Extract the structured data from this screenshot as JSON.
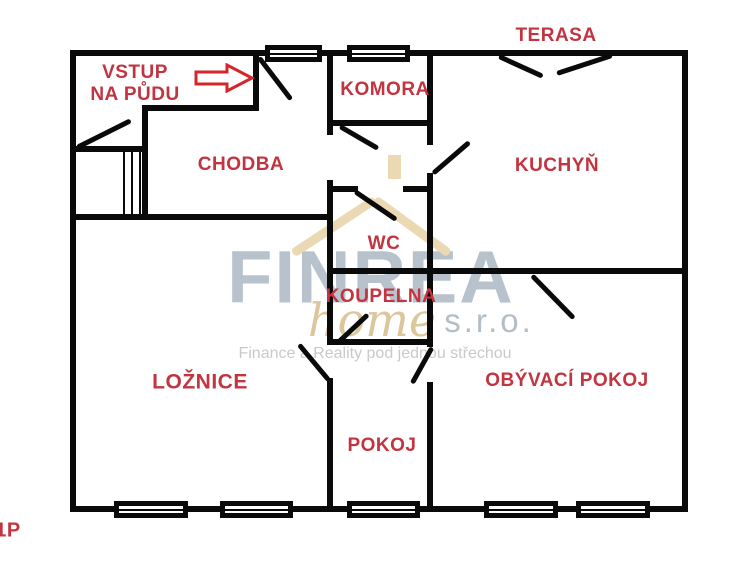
{
  "page": {
    "type": "floor-plan-image",
    "floor_tag": "1P"
  },
  "colors": {
    "wall": "#0a0a0a",
    "room_label": "#c23440",
    "arrow_outline": "#d4252b",
    "watermark_brand": "#b7c2cc",
    "watermark_home": "#dcc69c",
    "watermark_suffix": "#b3bec8",
    "watermark_tagline": "#c9c9c9",
    "watermark_roof": "#ead9b3",
    "background": "#ffffff"
  },
  "watermark": {
    "brand": "FINREA",
    "home": "home",
    "suffix": "s.r.o.",
    "tagline": "Finance a Reality pod jednou střechou"
  },
  "labels": [
    {
      "id": "vstup-na-pudu",
      "lines": [
        "VSTUP",
        "NA PŮDU"
      ],
      "x": 135,
      "y": 84,
      "fs": 19
    },
    {
      "id": "chodba",
      "lines": [
        "CHODBA"
      ],
      "x": 241,
      "y": 165,
      "fs": 19
    },
    {
      "id": "komora",
      "lines": [
        "KOMORA"
      ],
      "x": 385,
      "y": 90,
      "fs": 19
    },
    {
      "id": "terasa",
      "lines": [
        "TERASA"
      ],
      "x": 556,
      "y": 36,
      "fs": 19
    },
    {
      "id": "kuchyn",
      "lines": [
        "KUCHYŇ"
      ],
      "x": 557,
      "y": 166,
      "fs": 19
    },
    {
      "id": "wc",
      "lines": [
        "WC"
      ],
      "x": 384,
      "y": 244,
      "fs": 19
    },
    {
      "id": "koupelna",
      "lines": [
        "KOUPELNA"
      ],
      "x": 381,
      "y": 297,
      "fs": 19
    },
    {
      "id": "loznice",
      "lines": [
        "LOŽNICE"
      ],
      "x": 200,
      "y": 383,
      "fs": 21
    },
    {
      "id": "pokoj",
      "lines": [
        "POKOJ"
      ],
      "x": 382,
      "y": 446,
      "fs": 19
    },
    {
      "id": "obyvaci-pokoj",
      "lines": [
        "OBÝVACÍ POKOJ"
      ],
      "x": 567,
      "y": 381,
      "fs": 19
    },
    {
      "id": "floor-tag",
      "lines": [
        "1P"
      ],
      "x": 8,
      "y": 531,
      "fs": 20
    }
  ],
  "plan": {
    "walls": [
      [
        70,
        50,
        618,
        6
      ],
      [
        70,
        506,
        618,
        6
      ],
      [
        70,
        50,
        6,
        462
      ],
      [
        682,
        50,
        6,
        462
      ],
      [
        253,
        50,
        6,
        61
      ],
      [
        143,
        105,
        116,
        6
      ],
      [
        142,
        105,
        6,
        115
      ],
      [
        70,
        146,
        78,
        6
      ],
      [
        70,
        214,
        263,
        6
      ],
      [
        327,
        50,
        6,
        85
      ],
      [
        327,
        180,
        6,
        165
      ],
      [
        327,
        378,
        6,
        133
      ],
      [
        327,
        120,
        106,
        6
      ],
      [
        327,
        186,
        31,
        6
      ],
      [
        403,
        186,
        30,
        6
      ],
      [
        327,
        268,
        361,
        6
      ],
      [
        427,
        50,
        6,
        95
      ],
      [
        427,
        173,
        6,
        174
      ],
      [
        427,
        382,
        6,
        130
      ],
      [
        327,
        339,
        106,
        6
      ]
    ],
    "stairs": [
      [
        123,
        152,
        2,
        64
      ],
      [
        131,
        152,
        2,
        64
      ],
      [
        139,
        152,
        2,
        64
      ]
    ],
    "windows": [
      [
        265,
        45,
        57,
        17
      ],
      [
        347,
        45,
        63,
        17
      ],
      [
        114,
        501,
        74,
        17
      ],
      [
        220,
        501,
        73,
        17
      ],
      [
        347,
        501,
        73,
        17
      ],
      [
        484,
        501,
        74,
        17
      ],
      [
        576,
        501,
        74,
        17
      ]
    ],
    "doors": [
      [
        77,
        147,
        131,
        120
      ],
      [
        259,
        57,
        291,
        99
      ],
      [
        340,
        126,
        378,
        148
      ],
      [
        355,
        191,
        396,
        219
      ],
      [
        433,
        173,
        469,
        142
      ],
      [
        499,
        56,
        543,
        76
      ],
      [
        612,
        55,
        557,
        73
      ],
      [
        532,
        275,
        574,
        318
      ],
      [
        299,
        344,
        329,
        380
      ],
      [
        368,
        314,
        338,
        342
      ],
      [
        432,
        347,
        412,
        383
      ]
    ],
    "roof": {
      "slopes": [
        [
          293,
          253,
          375,
          199
        ],
        [
          375,
          199,
          449,
          253
        ]
      ],
      "chimney": [
        388,
        155,
        13,
        24
      ]
    },
    "arrow": {
      "x": 193,
      "y": 63,
      "w": 62,
      "h": 30
    }
  }
}
